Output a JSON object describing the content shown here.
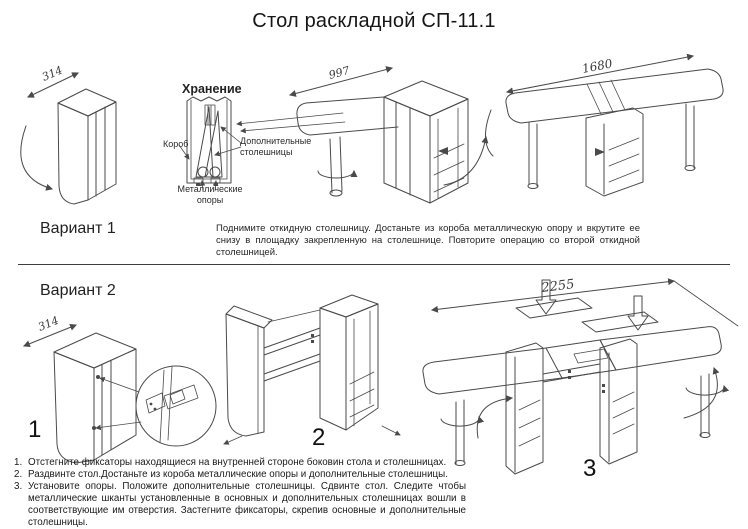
{
  "title": "Стол раскладной СП-11.1",
  "colors": {
    "line": "#4a4a4a",
    "text": "#1c1c1c",
    "background": "#ffffff"
  },
  "variant1": {
    "label": "Вариант 1",
    "folded_dimension": "314",
    "storage": {
      "heading": "Хранение",
      "box_label": "Короб",
      "extra_tops_label": "Дополнительные столешницы",
      "metal_supports_label": "Металлические опоры"
    },
    "half_open_dimension": "997",
    "full_open_dimension": "1680",
    "instructions": "Поднимите откидную столешницу. Достаньте из короба металлическую опору и вкрутите ее снизу в площадку закрепленную на столешнице. Повторите операцию со второй откидной столешницей."
  },
  "variant2": {
    "label": "Вариант 2",
    "folded_dimension": "314",
    "extended_dimension": "2255",
    "step_markers": {
      "one": "1",
      "two": "2",
      "three": "3"
    },
    "steps": [
      {
        "num": "1.",
        "text": "Отстегните фиксаторы находящиеся на внутренней стороне боковин стола и столешницах."
      },
      {
        "num": "2.",
        "text": "Раздвинте стол.Достаньте из короба металлические опоры и дополнительные столешницы."
      },
      {
        "num": "3.",
        "text": "Установите опоры. Положите дополнительные столешницы. Сдвинте стол. Следите чтобы металлические шканты установленные в основных и дополнительных столешницах вошли в соответствующие им отверстия. Застегните фиксаторы, скрепив основные и дополнительные столешницы."
      }
    ]
  }
}
